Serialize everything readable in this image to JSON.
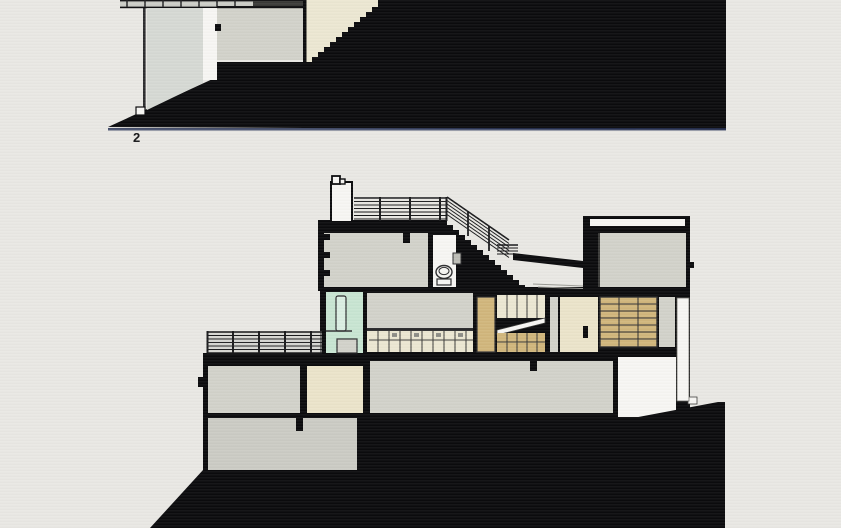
{
  "figure": {
    "upper_drawing": {
      "label": "2"
    },
    "lower_drawing": {
      "label": ""
    }
  },
  "palette": {
    "bg": "#e9e8e4",
    "ink": "#0b0b0d",
    "navy": "#2a3558",
    "gray": "#d2d2ca",
    "gray2": "#cccdc7",
    "glass": "#d6d9d4",
    "cream": "#ece7d2",
    "cream2": "#ebe4ca",
    "mint": "#c8e5d2",
    "mint2": "#daeee2",
    "tan": "#d1b67c",
    "white": "#f7f6f3",
    "rail": "#c9c9c4",
    "dkline": "#1a1a1c"
  }
}
